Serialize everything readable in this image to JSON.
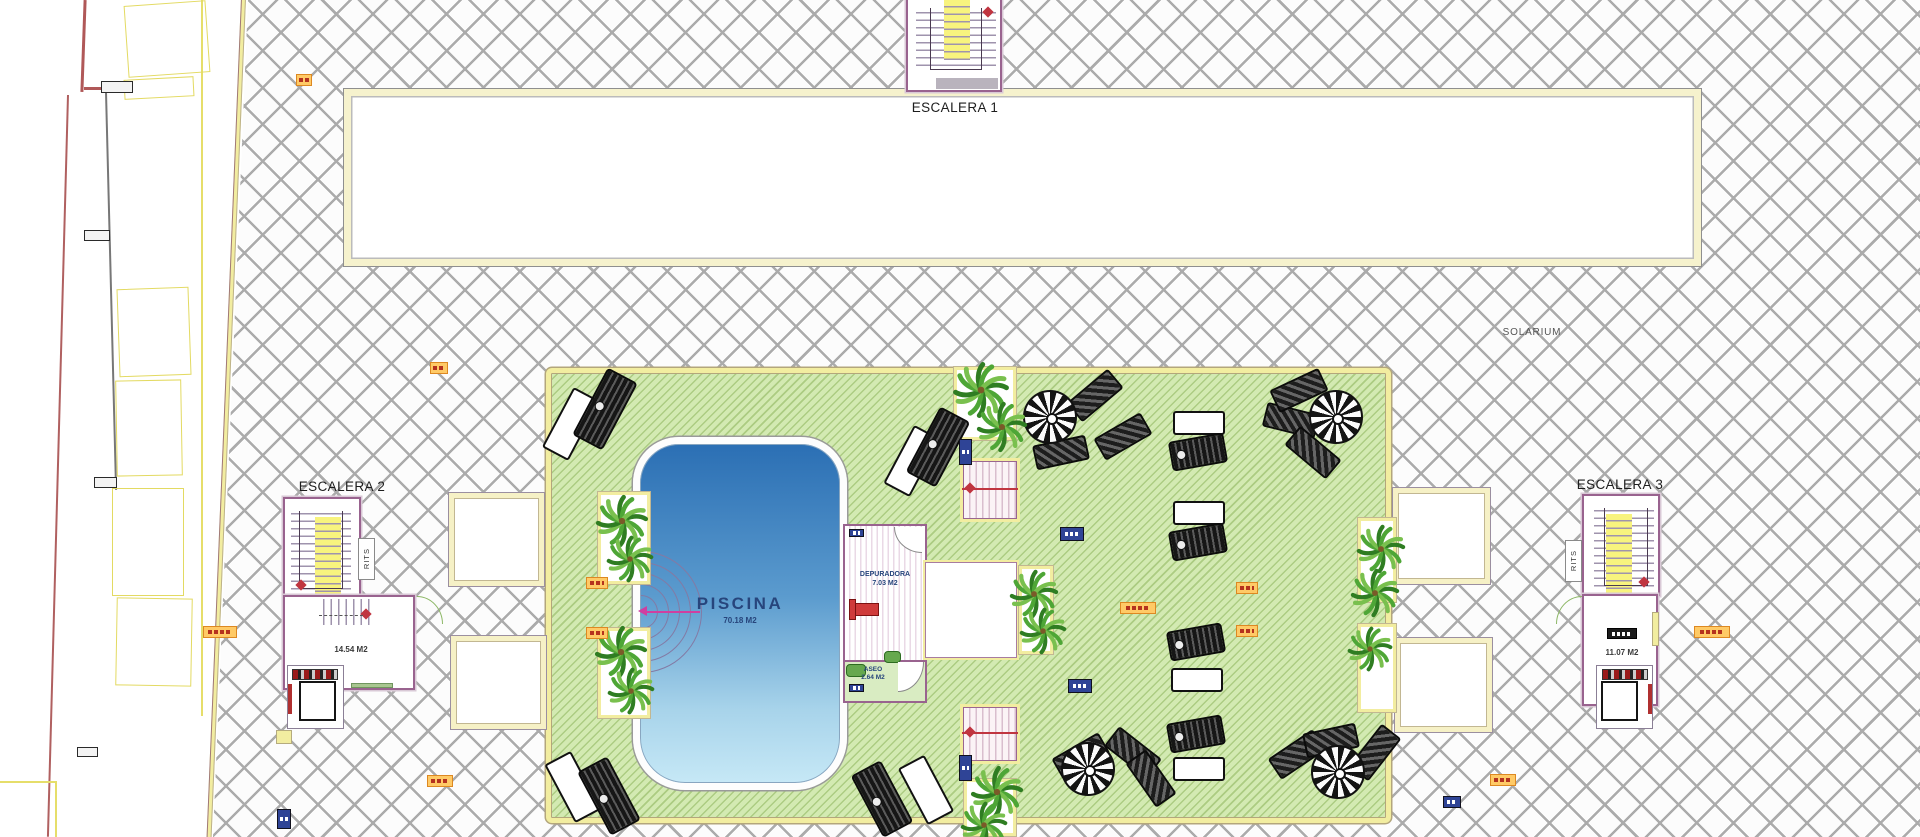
{
  "labels": {
    "escalera1": "ESCALERA 1",
    "escalera2": "ESCALERA 2",
    "escalera3": "ESCALERA 3",
    "solarium": "SOLARIUM",
    "rits": "RITS",
    "piscina": "PISCINA",
    "piscina_area": "70.18 M2",
    "depuradora": "DEPURADORA",
    "depuradora_area": "7.03 M2",
    "aseo": "ASEO",
    "aseo_area": "2.64 M2",
    "lobby2_area": "14.54 M2",
    "lobby3_area": "11.07 M2"
  },
  "colors": {
    "lawn": "#d3eab2",
    "lawn_stripe": "#8cb45a",
    "deck_border": "#f2eda0",
    "hatch_line": "#ababab",
    "pool_top": "#2b6fb4",
    "pool_bottom": "#c6e8f6",
    "wall": "#99638f",
    "stair_yellow": "#f8f37e",
    "accent_red": "#c03540",
    "arrow_magenta": "#cf3fa0",
    "tag_orange": "#ffca66",
    "tag_blue": "#2f4496",
    "text_navy": "#27457c"
  },
  "furniture": {
    "white_loungers": [
      [
        1173,
        411,
        52,
        24,
        0
      ],
      [
        1173,
        501,
        52,
        24,
        0
      ],
      [
        1171,
        668,
        52,
        24,
        0
      ],
      [
        1173,
        757,
        52,
        24,
        0
      ],
      [
        556,
        390,
        30,
        68,
        28
      ],
      [
        897,
        428,
        30,
        66,
        28
      ],
      [
        558,
        754,
        30,
        66,
        -28
      ],
      [
        911,
        758,
        30,
        64,
        -28
      ]
    ],
    "black_loungers": [
      [
        1170,
        437,
        56,
        30,
        -10
      ],
      [
        1170,
        527,
        56,
        30,
        -10
      ],
      [
        1168,
        627,
        56,
        30,
        -10
      ],
      [
        1168,
        719,
        56,
        30,
        -10
      ],
      [
        588,
        371,
        34,
        76,
        28
      ],
      [
        921,
        410,
        34,
        74,
        28
      ],
      [
        592,
        760,
        34,
        72,
        -28
      ],
      [
        865,
        764,
        34,
        70,
        -28
      ]
    ],
    "striped_loungers": [
      [
        1068,
        383,
        -40
      ],
      [
        1034,
        440,
        -12
      ],
      [
        1096,
        424,
        -30
      ],
      [
        1264,
        408,
        14
      ],
      [
        1286,
        440,
        40
      ],
      [
        1272,
        378,
        -25
      ],
      [
        1106,
        740,
        38
      ],
      [
        1054,
        744,
        -30
      ],
      [
        1124,
        766,
        55
      ],
      [
        1270,
        742,
        -34
      ],
      [
        1304,
        728,
        -12
      ],
      [
        1348,
        740,
        -52
      ]
    ],
    "parasols": [
      [
        1050,
        417
      ],
      [
        1336,
        417
      ],
      [
        1088,
        769
      ],
      [
        1338,
        772
      ]
    ],
    "palms": [
      [
        622,
        521,
        28
      ],
      [
        630,
        559,
        25
      ],
      [
        621,
        652,
        28
      ],
      [
        631,
        691,
        25
      ],
      [
        981,
        390,
        30
      ],
      [
        1002,
        427,
        27
      ],
      [
        1034,
        594,
        26
      ],
      [
        1043,
        631,
        25
      ],
      [
        1381,
        549,
        26
      ],
      [
        1375,
        593,
        26
      ],
      [
        1370,
        649,
        24
      ],
      [
        997,
        792,
        28
      ],
      [
        984,
        825,
        25
      ]
    ],
    "planters": [
      [
        598,
        492,
        52,
        92
      ],
      [
        598,
        628,
        52,
        90
      ],
      [
        954,
        367,
        62,
        73
      ],
      [
        1019,
        566,
        34,
        88
      ],
      [
        1358,
        518,
        38,
        84
      ],
      [
        1358,
        624,
        38,
        88
      ],
      [
        964,
        779,
        52,
        57
      ]
    ],
    "deck_squares": [
      [
        448,
        492,
        97,
        95
      ],
      [
        450,
        635,
        97,
        95
      ],
      [
        1392,
        487,
        99,
        98
      ],
      [
        1394,
        637,
        99,
        96
      ]
    ],
    "orange_tags": [
      [
        296,
        74,
        16
      ],
      [
        430,
        362,
        18
      ],
      [
        586,
        577,
        22
      ],
      [
        586,
        627,
        22
      ],
      [
        427,
        775,
        26
      ],
      [
        1120,
        602,
        36
      ],
      [
        1236,
        582,
        22
      ],
      [
        1236,
        625,
        22
      ],
      [
        1490,
        774,
        26
      ],
      [
        1694,
        626,
        36
      ],
      [
        203,
        626,
        34
      ]
    ],
    "blue_tags": [
      [
        1060,
        527,
        24,
        14
      ],
      [
        1068,
        679,
        24,
        14
      ],
      [
        959,
        439,
        13,
        26
      ],
      [
        959,
        755,
        13,
        26
      ],
      [
        277,
        809,
        14,
        20
      ],
      [
        1443,
        796,
        18,
        12
      ],
      [
        849,
        529,
        15,
        8
      ],
      [
        849,
        684,
        15,
        8
      ]
    ],
    "left_boxes": [
      [
        126,
        3,
        82,
        72,
        -4
      ],
      [
        124,
        78,
        70,
        20,
        -3
      ],
      [
        118,
        288,
        72,
        88,
        -2
      ],
      [
        116,
        380,
        66,
        96,
        -1
      ],
      [
        112,
        488,
        72,
        108,
        0
      ],
      [
        116,
        598,
        76,
        88,
        1
      ]
    ],
    "left_markers": [
      [
        101,
        81,
        32,
        12
      ],
      [
        84,
        230,
        26,
        11
      ],
      [
        94,
        477,
        23,
        11
      ],
      [
        77,
        747,
        21,
        10
      ]
    ]
  }
}
